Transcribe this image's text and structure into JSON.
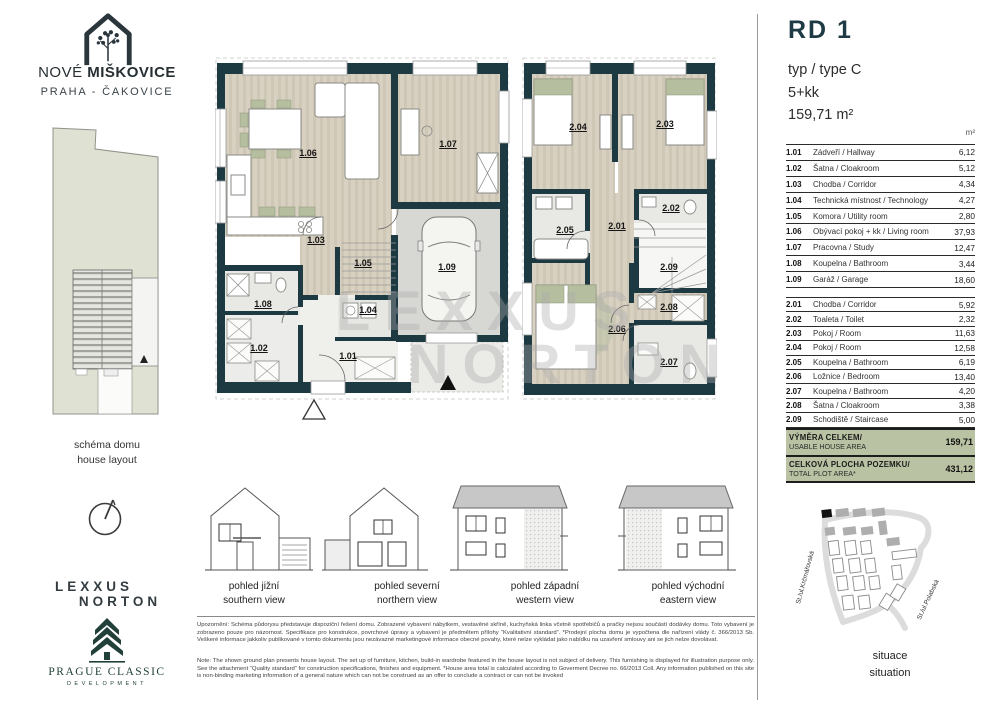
{
  "brand": {
    "project_light": "NOVÉ",
    "project_bold": "MIŠKOVICE",
    "location": "PRAHA - ČAKOVICE",
    "schema_caption_cz": "schéma domu",
    "schema_caption_en": "house layout",
    "agency_line1": "LEXXUS",
    "agency_line2": "NORTON",
    "developer_line1": "PRAGUE CLASSIC",
    "developer_line2": "DEVELOPMENT"
  },
  "header": {
    "unit_id": "RD 1",
    "type": "typ / type C",
    "disposition": "5+kk",
    "total_area": "159,71 m²",
    "column_unit": "m²"
  },
  "rooms_floor1": [
    {
      "id": "1.01",
      "name": "Zádveří / Hallway",
      "area": "6,12"
    },
    {
      "id": "1.02",
      "name": "Šatna / Cloakroom",
      "area": "5,12"
    },
    {
      "id": "1.03",
      "name": "Chodba / Corridor",
      "area": "4,34"
    },
    {
      "id": "1.04",
      "name": "Technická místnost / Technology",
      "area": "4,27"
    },
    {
      "id": "1.05",
      "name": "Komora / Utility room",
      "area": "2,80"
    },
    {
      "id": "1.06",
      "name": "Obývací pokoj + kk / Living room",
      "area": "37,93"
    },
    {
      "id": "1.07",
      "name": "Pracovna / Study",
      "area": "12,47"
    },
    {
      "id": "1.08",
      "name": "Koupelna / Bathroom",
      "area": "3,44"
    },
    {
      "id": "1.09",
      "name": "Garáž / Garage",
      "area": "18,60"
    }
  ],
  "rooms_floor2": [
    {
      "id": "2.01",
      "name": "Chodba / Corridor",
      "area": "5,92"
    },
    {
      "id": "2.02",
      "name": "Toaleta / Toilet",
      "area": "2,32"
    },
    {
      "id": "2.03",
      "name": "Pokoj / Room",
      "area": "11,63"
    },
    {
      "id": "2.04",
      "name": "Pokoj / Room",
      "area": "12,58"
    },
    {
      "id": "2.05",
      "name": "Koupelna / Bathroom",
      "area": "6,19"
    },
    {
      "id": "2.06",
      "name": "Ložnice / Bedroom",
      "area": "13,40"
    },
    {
      "id": "2.07",
      "name": "Koupelna / Bathroom",
      "area": "4,20"
    },
    {
      "id": "2.08",
      "name": "Šatna / Cloakroom",
      "area": "3,38"
    },
    {
      "id": "2.09",
      "name": "Schodiště / Staircase",
      "area": "5,00"
    }
  ],
  "summary": [
    {
      "label_cz": "VÝMĚRA CELKEM/",
      "label_en": "USABLE HOUSE AREA",
      "value": "159,71"
    },
    {
      "label_cz": "CELKOVÁ PLOCHA POZEMKU/",
      "label_en": "TOTAL PLOT AREA*",
      "value": "431,12"
    }
  ],
  "elevations": [
    {
      "cz": "pohled jižní",
      "en": "southern view"
    },
    {
      "cz": "pohled severní",
      "en": "northern view"
    },
    {
      "cz": "pohled západní",
      "en": "western view"
    },
    {
      "cz": "pohled východní",
      "en": "eastern view"
    }
  ],
  "situation": {
    "caption_cz": "situace",
    "caption_en": "situation",
    "street_left": "St./ul.Krčmářovská",
    "street_right": "St./ul.Polabská"
  },
  "watermark": {
    "line1": "LEXXUS",
    "line2": "NORTON"
  },
  "notes": {
    "cz": "Upozornění: Schéma půdorysu představuje dispoziční řešení domu. Zobrazené vybavení nábytkem, vestavěné skříně, kuchyňská linka včetně spotřebičů a pračky nejsou součástí dodávky domu. Toto vybavení je zobrazeno pouze pro názornost. Specifikace pro konstrukce, povrchové úpravy a vybavení je předmětem přílohy “Kvalitativní standard”. *Prodejní plocha domu je vypočtena dle nařízení vlády č. 366/2013 Sb. Veškeré informace jakkoliv publikované v tomto dokumentu jsou nezávazné marketingové informace obecné povahy, které nelze vykládat jako nabídku na uzavření smlouvy ani se jich nelze dovolávat.",
    "en": "Note: The shown ground plan presents house layout. The set up of furniture, kitchen, build-in wardrobe featured in the house layout is not subject of delivery. This furnishing is displayed for illustration purpose only. See the attachment “Quality standard” for construction specifications, finishes and equipment. *House area total is calculated according to Goverment Decree no. 66/2013 Coll. Any information published on this site is non-binding marketing information of a general nature which can not be construed as an offer to conclude a contract or can not be invoked"
  },
  "colors": {
    "wall": "#1d3a43",
    "accent_sage": "#b5bf9f",
    "summary_bg": "#b9c2a2",
    "title": "#1e3a44",
    "plot_fill": "#dfe2d2"
  }
}
